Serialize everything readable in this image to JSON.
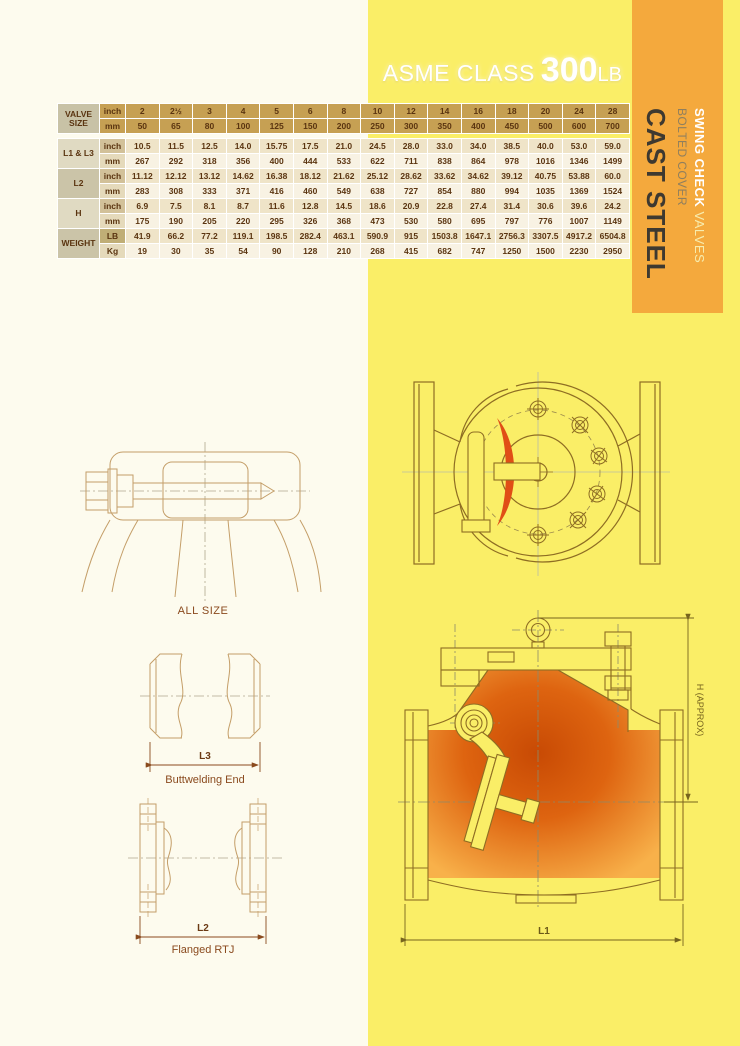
{
  "header": {
    "class_label": "ASME CLASS",
    "rating": "300",
    "rating_unit": "LB"
  },
  "sidebar": {
    "product_bold": "SWING CHECK",
    "product_rest": " VALVES",
    "subtitle": "BOLTED COVER",
    "material": "CAST STEEL"
  },
  "table": {
    "corner_label": "VALVE SIZE",
    "header_unit_top": "inch",
    "header_unit_bottom": "mm",
    "sizes_inch": [
      "2",
      "2½",
      "3",
      "4",
      "5",
      "6",
      "8",
      "10",
      "12",
      "14",
      "16",
      "18",
      "20",
      "24",
      "28"
    ],
    "sizes_mm": [
      "50",
      "65",
      "80",
      "100",
      "125",
      "150",
      "200",
      "250",
      "300",
      "350",
      "400",
      "450",
      "500",
      "600",
      "700"
    ],
    "rows": [
      {
        "label": "L1 & L3",
        "unit_top": "inch",
        "unit_bottom": "mm",
        "top": [
          "10.5",
          "11.5",
          "12.5",
          "14.0",
          "15.75",
          "17.5",
          "21.0",
          "24.5",
          "28.0",
          "33.0",
          "34.0",
          "38.5",
          "40.0",
          "53.0",
          "59.0"
        ],
        "bottom": [
          "267",
          "292",
          "318",
          "356",
          "400",
          "444",
          "533",
          "622",
          "711",
          "838",
          "864",
          "978",
          "1016",
          "1346",
          "1499"
        ]
      },
      {
        "label": "L2",
        "unit_top": "inch",
        "unit_bottom": "mm",
        "top": [
          "11.12",
          "12.12",
          "13.12",
          "14.62",
          "16.38",
          "18.12",
          "21.62",
          "25.12",
          "28.62",
          "33.62",
          "34.62",
          "39.12",
          "40.75",
          "53.88",
          "60.0"
        ],
        "bottom": [
          "283",
          "308",
          "333",
          "371",
          "416",
          "460",
          "549",
          "638",
          "727",
          "854",
          "880",
          "994",
          "1035",
          "1369",
          "1524"
        ]
      },
      {
        "label": "H",
        "unit_top": "inch",
        "unit_bottom": "mm",
        "top": [
          "6.9",
          "7.5",
          "8.1",
          "8.7",
          "11.6",
          "12.8",
          "14.5",
          "18.6",
          "20.9",
          "22.8",
          "27.4",
          "31.4",
          "30.6",
          "39.6",
          "24.2"
        ],
        "bottom": [
          "175",
          "190",
          "205",
          "220",
          "295",
          "326",
          "368",
          "473",
          "530",
          "580",
          "695",
          "797",
          "776",
          "1007",
          "1149"
        ]
      },
      {
        "label": "WEIGHT",
        "unit_top": "LB",
        "unit_bottom": "Kg",
        "top": [
          "41.9",
          "66.2",
          "77.2",
          "119.1",
          "198.5",
          "282.4",
          "463.1",
          "590.9",
          "915",
          "1503.8",
          "1647.1",
          "2756.3",
          "3307.5",
          "4917.2",
          "6504.8"
        ],
        "bottom": [
          "19",
          "30",
          "35",
          "54",
          "90",
          "128",
          "210",
          "268",
          "415",
          "682",
          "747",
          "1250",
          "1500",
          "2230",
          "2950"
        ]
      }
    ]
  },
  "drawings": {
    "all_size_caption": "ALL SIZE",
    "buttweld_dim": "L3",
    "buttweld_caption": "Buttwelding End",
    "flanged_dim": "L2",
    "flanged_caption": "Flanged RTJ",
    "section_height_dim": "H (APPROX)",
    "section_length_dim": "L1"
  },
  "colors": {
    "yellow": "#FAEE67",
    "cream": "#FDFBEE",
    "orange_panel": "#F4A93D",
    "table_gold": "#C6A053",
    "line_light": "#C49E68",
    "line_dark": "#8E6D23",
    "accent_red": "#E04E16"
  }
}
